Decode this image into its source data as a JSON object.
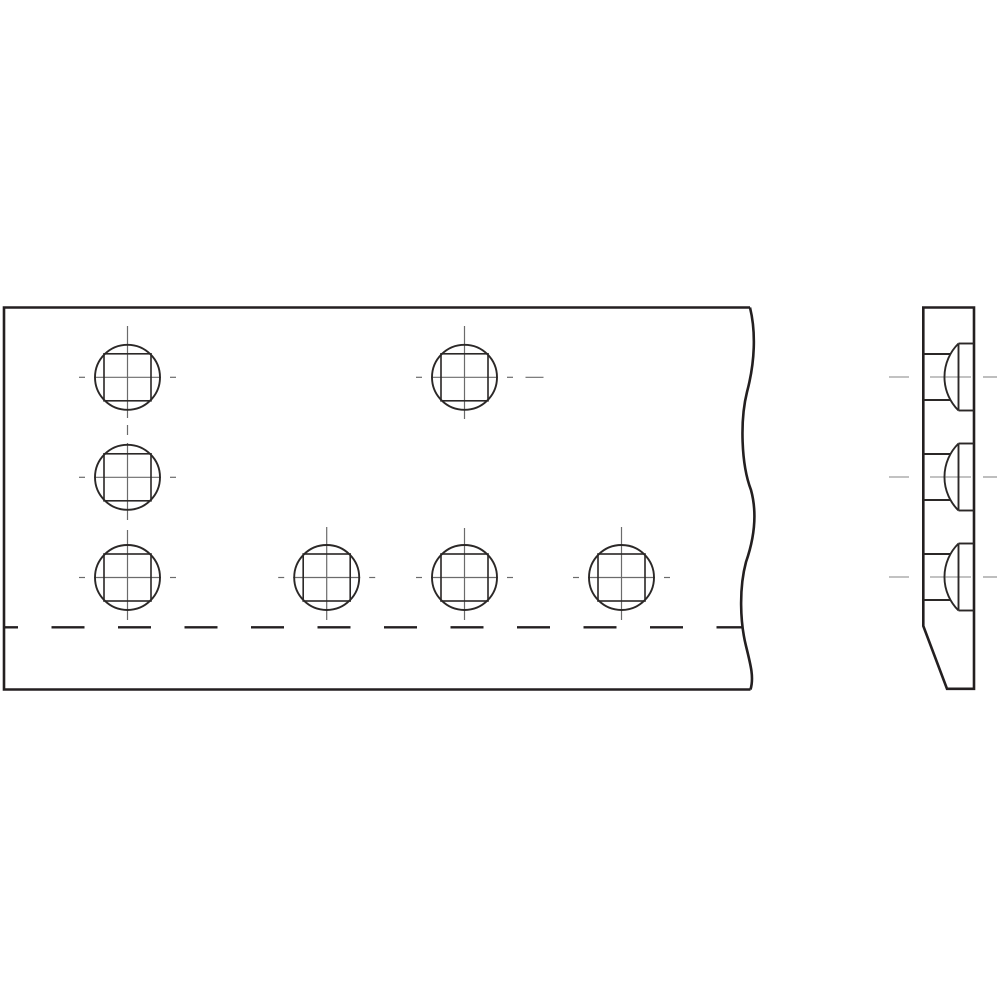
{
  "drawing": {
    "title": "plate-with-carriage-bolts",
    "canvas": {
      "width": 1000,
      "height": 1000,
      "background": "#ffffff"
    },
    "style": {
      "ink": "#231f20",
      "feature_ink": "#2b2827",
      "centerline_color": "#6b6b6b",
      "side_centerline_color": "#aeaeae",
      "outline_width": 2.6,
      "feature_width": 1.9,
      "centerline_width": 1.2,
      "hidden_width": 2.4,
      "side_centerline_width": 1.6
    },
    "front_view": {
      "name": "front-view",
      "outline": {
        "left": 4,
        "top": 307.5,
        "bottom": 689.5,
        "top_right_x": 750,
        "bottom_right_x": 750.5,
        "break_line_path": "M 750 307.5 C 756 332 755 362 747 392 C 740 420 741 464 751 490 C 757 512 755 536 746 562 C 739 588 740 622 746 646 C 751 666 754 678 750.5 689.5"
      },
      "hidden_edge": {
        "y": 627.3,
        "x1": 5,
        "x2": 743,
        "dash": 33,
        "gap": 33.5,
        "dash_offset": 20
      },
      "hole_style": {
        "circle_r": 32.5,
        "square_half": 23.5,
        "h_centerline_offsets": [
          [
            -48.5,
            -42.5
          ],
          [
            -33.5,
            33.5
          ],
          [
            42.5,
            48.5
          ]
        ]
      },
      "holes": [
        {
          "cx": 127.5,
          "cy": 377.3,
          "v": [
            [
              326,
              418
            ],
            [
              425,
              435
            ]
          ]
        },
        {
          "cx": 127.5,
          "cy": 477.3,
          "v": [
            [
              443,
              520
            ]
          ]
        },
        {
          "cx": 127.5,
          "cy": 577.5,
          "v": [
            [
              530,
              620
            ]
          ]
        },
        {
          "cx": 464.5,
          "cy": 377.3,
          "v": [
            [
              326,
              419
            ]
          ],
          "h_extra": [
            [
              61,
              79
            ]
          ]
        },
        {
          "cx": 326.7,
          "cy": 577.5,
          "v": [
            [
              527,
              620
            ]
          ]
        },
        {
          "cx": 464.5,
          "cy": 577.5,
          "v": [
            [
              528,
              620
            ]
          ]
        },
        {
          "cx": 621.5,
          "cy": 577.5,
          "v": [
            [
              527,
              620
            ]
          ]
        }
      ]
    },
    "side_view": {
      "name": "side-view",
      "outline": {
        "left": 923.3,
        "right": 974,
        "top": 307.5,
        "bottom": 688.8,
        "chamfer_start_y": 626,
        "chamfer_end_x": 947
      },
      "bolt_style": {
        "head_face_x": 958.5,
        "head_half": 33.5,
        "head_outer_x": 974,
        "dome_radius": 47,
        "neck_half": 23,
        "neck_x0": 923.3,
        "neck_x1": 950
      },
      "bolts": [
        {
          "cy": 377
        },
        {
          "cy": 477
        },
        {
          "cy": 577
        }
      ],
      "centerline_segments": [
        [
          889,
          909
        ],
        [
          930,
          971
        ],
        [
          983,
          997
        ]
      ]
    }
  }
}
